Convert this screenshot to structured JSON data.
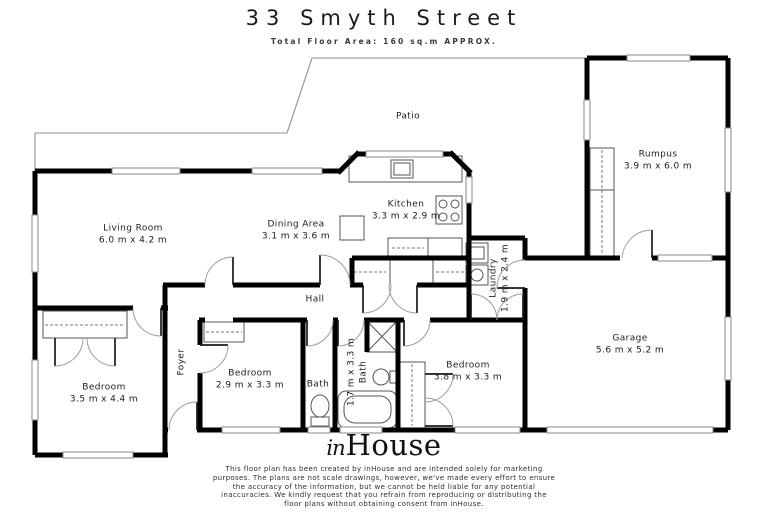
{
  "header": {
    "title": "33 Smyth Street",
    "subtitle": "Total Floor Area: 160 sq.m APPROX."
  },
  "rooms": {
    "patio": {
      "name": "Patio"
    },
    "living": {
      "name": "Living Room",
      "dims": "6.0 m x 4.2 m"
    },
    "dining": {
      "name": "Dining Area",
      "dims": "3.1 m x 3.6 m"
    },
    "kitchen": {
      "name": "Kitchen",
      "dims": "3.3 m x 2.9 m"
    },
    "laundry": {
      "name": "Laundry",
      "dims": "1.9 m x 2.4 m"
    },
    "rumpus": {
      "name": "Rumpus",
      "dims": "3.9 m x 6.0 m"
    },
    "garage": {
      "name": "Garage",
      "dims": "5.6 m x 5.2 m"
    },
    "hall": {
      "name": "Hall"
    },
    "foyer": {
      "name": "Foyer"
    },
    "bedroom1": {
      "name": "Bedroom",
      "dims": "3.5 m x 4.4 m"
    },
    "bedroom2": {
      "name": "Bedroom",
      "dims": "2.9 m x 3.3 m"
    },
    "bath_small": {
      "name": "Bath"
    },
    "bath_main": {
      "name": "Bath",
      "dims": "1.7 m x 3.3 m"
    },
    "bedroom3": {
      "name": "Bedroom",
      "dims": "3.8 m x 3.3 m"
    }
  },
  "footer": {
    "logo_in": "in",
    "logo_house": "House",
    "disclaimer_lines": [
      "This floor plan has been created by inHouse and are intended solely for marketing",
      "purposes. The plans are not scale drawings, however, we've made every effort to ensure",
      "the accuracy of the information, but we cannot be held liable for any potential",
      "inaccuracies. We kindly request that you refrain from reproducing or distributing the",
      "floor plans without obtaining consent from inHouse."
    ]
  },
  "colors": {
    "wall": "#000000",
    "thin_line": "#8f8f8f",
    "text": "#1c1c1c"
  }
}
